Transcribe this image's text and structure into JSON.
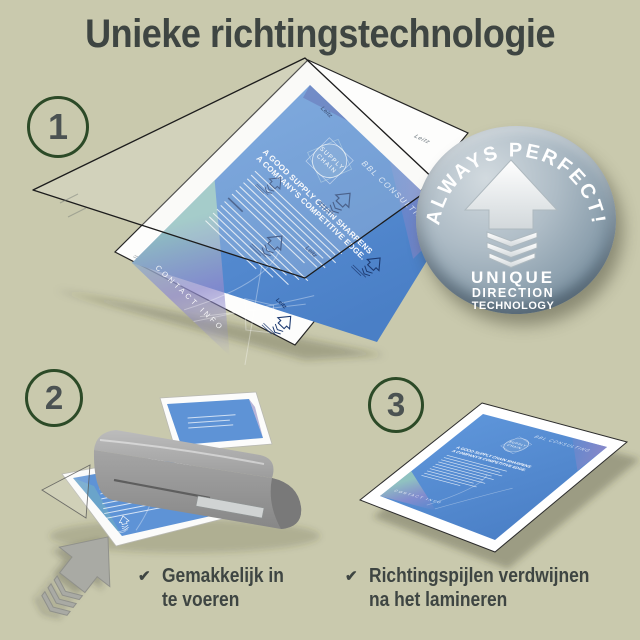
{
  "title": "Unieke richtingstechnologie",
  "steps": {
    "one": "1",
    "two": "2",
    "three": "3"
  },
  "badge": {
    "arc_text": "ALWAYS PERFECT!",
    "line1": "UNIQUE",
    "line2": "DIRECTION",
    "line3": "TECHNOLOGY"
  },
  "document": {
    "brand": "BBL CONSULTING",
    "logo_line1": "SUPPLY",
    "logo_line2": "CHAIN",
    "heading_line1": "A GOOD SUPPLY CHAIN SHARPENS",
    "heading_line2": "A COMPANY'S COMPETITIVE EDGE.",
    "footer": "CONTACT INFO"
  },
  "pouch": {
    "watermark": "Leitz"
  },
  "icons": {
    "check": "✔"
  },
  "captions": {
    "left_line1": "Gemakkelijk in",
    "left_line2": "te voeren",
    "right_line1": "Richtingspijlen verdwijnen",
    "right_line2": "na het lamineren"
  },
  "colors": {
    "background": "#c9c9ad",
    "text": "#3e4542",
    "circle_border": "#2c4a27",
    "document_blue": "#5b90d6",
    "print_navy": "#1d3a70",
    "badge_metal": "#8ea2b1",
    "laminator_gray": "#9b9b9b"
  }
}
